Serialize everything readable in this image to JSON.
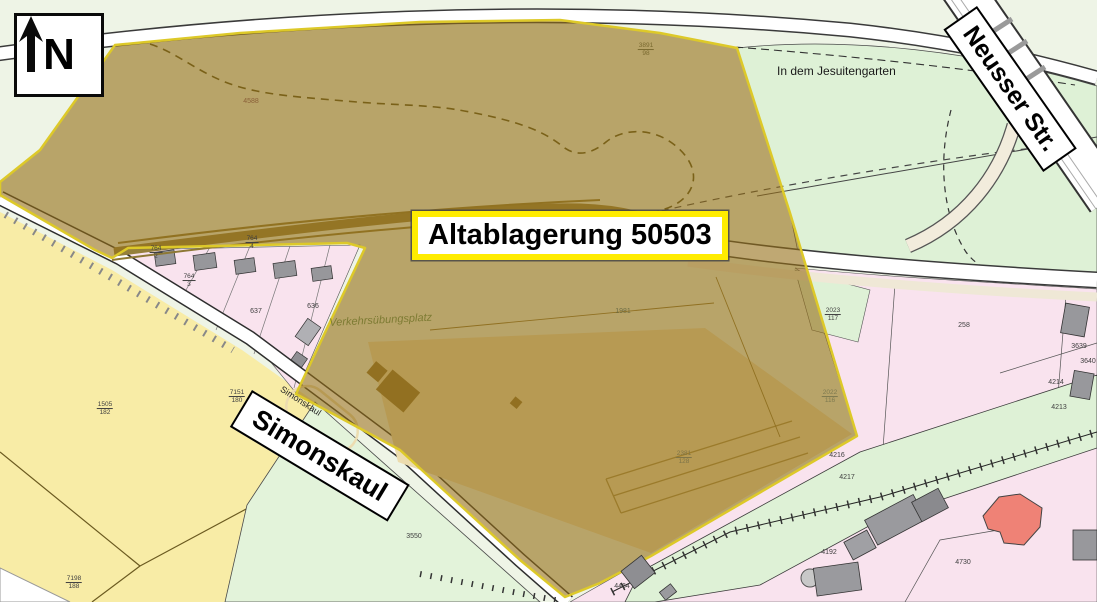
{
  "compass": {
    "label": "N"
  },
  "site": {
    "label": "Altablagerung 50503"
  },
  "streets": {
    "neusser": "Neusser Str.",
    "simonskaul_sign": "Simonskaul",
    "simonskaul_road": "Simonskaul"
  },
  "areas": {
    "jesuitengarten": "In dem Jesuitengarten",
    "verkehrsuebungsplatz": "Verkehrsübungsplatz"
  },
  "parcels": [
    {
      "text": "4588",
      "x": 251,
      "y": 102,
      "color": "#8a5f38"
    },
    {
      "text": "3891/98",
      "x": 646,
      "y": 50,
      "color": "#7a6a30"
    },
    {
      "text": "1981",
      "x": 623,
      "y": 312,
      "color": "#6d6d45"
    },
    {
      "text": "2023/117",
      "x": 833,
      "y": 315
    },
    {
      "text": "2022/116",
      "x": 830,
      "y": 397,
      "color": "#7e7a50"
    },
    {
      "text": "2381/128",
      "x": 684,
      "y": 458,
      "color": "#7e7448"
    },
    {
      "text": "258",
      "x": 964,
      "y": 326
    },
    {
      "text": "4214",
      "x": 1056,
      "y": 383
    },
    {
      "text": "4213",
      "x": 1059,
      "y": 408
    },
    {
      "text": "3639",
      "x": 1079,
      "y": 347
    },
    {
      "text": "3640",
      "x": 1088,
      "y": 362
    },
    {
      "text": "4216",
      "x": 837,
      "y": 456
    },
    {
      "text": "4217",
      "x": 847,
      "y": 478
    },
    {
      "text": "4192",
      "x": 829,
      "y": 553
    },
    {
      "text": "4464",
      "x": 622,
      "y": 587
    },
    {
      "text": "4730",
      "x": 963,
      "y": 563
    },
    {
      "text": "3550",
      "x": 414,
      "y": 537
    },
    {
      "text": "1505/182",
      "x": 105,
      "y": 409
    },
    {
      "text": "7198/188",
      "x": 74,
      "y": 583
    },
    {
      "text": "7151/180",
      "x": 237,
      "y": 397
    },
    {
      "text": "764/2",
      "x": 156,
      "y": 253
    },
    {
      "text": "764/3",
      "x": 189,
      "y": 281
    },
    {
      "text": "764/4",
      "x": 252,
      "y": 243
    },
    {
      "text": "637",
      "x": 256,
      "y": 312
    },
    {
      "text": "636",
      "x": 313,
      "y": 307
    }
  ],
  "colors": {
    "overlay_fill": "rgba(148,110,22,0.60)",
    "overlay_border": "#ddc929",
    "label_border": "#ffec00",
    "pink": "#f9e3ee",
    "green_top": "#eef4e6",
    "green_field": "#def1d6",
    "green_mint": "#e3f3da",
    "yellow_field": "#f8eca6",
    "road": "#ffffff",
    "building_gray": "#97979b",
    "building_red": "#ef8276"
  }
}
